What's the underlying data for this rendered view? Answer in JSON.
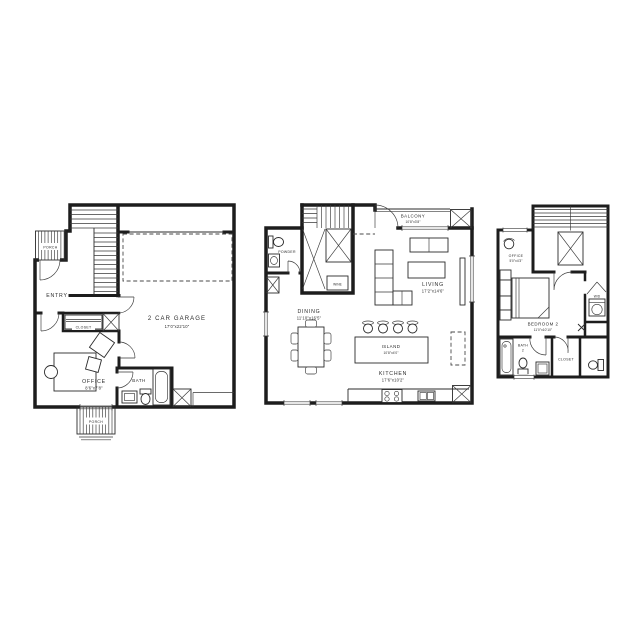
{
  "colors": {
    "line": "#1d1d1d",
    "background": "#ffffff"
  },
  "plans": [
    {
      "name": "first-floor",
      "rooms": {
        "porch_top": {
          "label": "PORCH"
        },
        "entry": {
          "label": "ENTRY"
        },
        "closet": {
          "label": "CLOSET"
        },
        "garage": {
          "label": "2 CAR GARAGE",
          "dims": "17'0\"x22'10\""
        },
        "office": {
          "label": "OFFICE",
          "dims": "8'6\"x7'8\""
        },
        "bath": {
          "label": "BATH"
        },
        "porch_bottom": {
          "label": "PORCH"
        }
      }
    },
    {
      "name": "second-floor",
      "rooms": {
        "balcony": {
          "label": "BALCONY",
          "dims": "10'8\"x3'8\""
        },
        "powder": {
          "label": "POWDER"
        },
        "wine": {
          "label": "WINE"
        },
        "living": {
          "label": "LIVING",
          "dims": "17'2\"x14'6\""
        },
        "dining": {
          "label": "DINING",
          "dims": "11'10\"x16'5\""
        },
        "island": {
          "label": "ISLAND",
          "dims": "10'8\"x4'0\""
        },
        "kitchen": {
          "label": "KITCHEN",
          "dims": "17'6\"x10'2\""
        }
      }
    },
    {
      "name": "third-floor",
      "rooms": {
        "office": {
          "label": "OFFICE",
          "dims": "5'0\"x4'3\""
        },
        "bedroom2": {
          "label": "BEDROOM 2",
          "dims": "11'0\"x10'10\""
        },
        "wd": {
          "label": "W/D"
        },
        "bath2": {
          "label": "BATH",
          "number": "2"
        },
        "closet": {
          "label": "CLOSET"
        }
      }
    }
  ]
}
